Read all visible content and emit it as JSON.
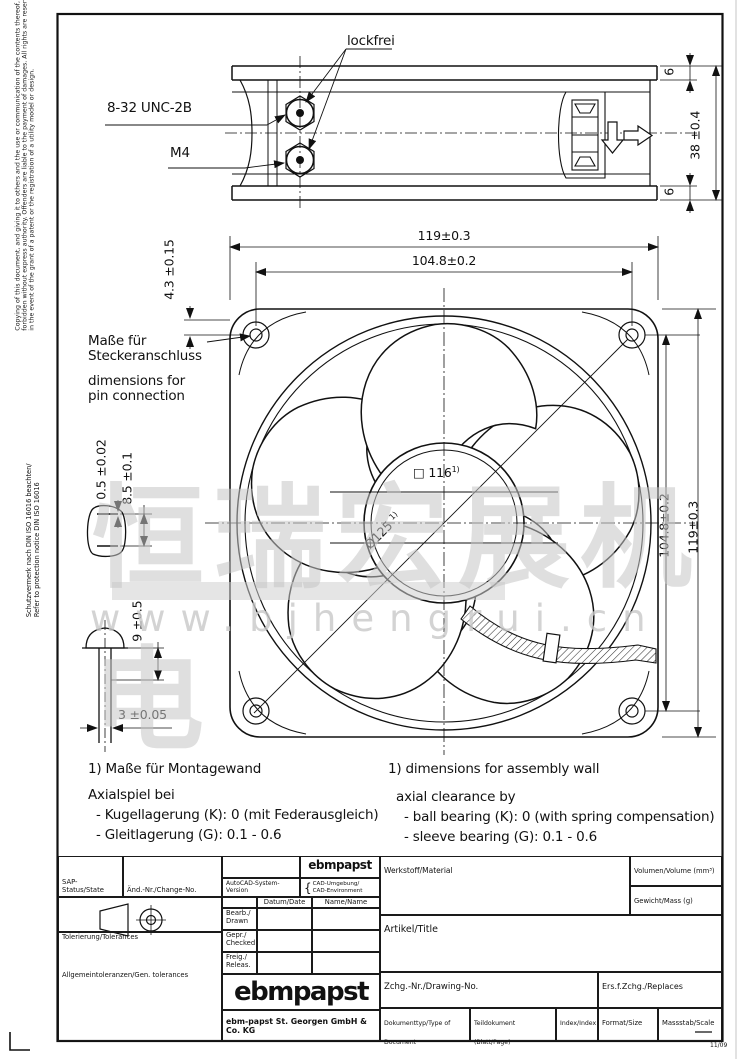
{
  "watermark": {
    "text": "恒瑞宏展机电",
    "url": "www.bjhengrui.cn"
  },
  "margin": {
    "copyright_line1": "Copying of this document, and giving it to others and the use or communication of the contents thereof, are",
    "copyright_line2": "forbidden without express authority. Offenders are liable to the payment of damages. All rights are reserved",
    "copyright_line3": "in the event of the grant of a patent or the registration of a utility model or design.",
    "protection_line1": "Schutzvermerk nach DIN ISO 16016 beachten/",
    "protection_line2": "Refer to protection notice DIN ISO 16016"
  },
  "top_view": {
    "lockfrei": "lockfrei",
    "thread_top": "8-32 UNC-2B",
    "thread_bottom": "M4",
    "dim_flange_top": "6",
    "dim_flange_bottom": "6",
    "dim_depth": "38 ±0.4"
  },
  "front_view": {
    "dim_width": "119±0.3",
    "dim_hole_pitch_top": "104.8±0.2",
    "dim_corner": "4.3 ±0.15",
    "dim_hole_pitch_right": "104.8±0.2",
    "dim_height": "119±0.3",
    "square_symbol": "□",
    "square_value": "116",
    "ref_sup": "1)",
    "diameter_label": "Ø125",
    "pin_note_de1": "Maße für",
    "pin_note_de2": "Steckeranschluss",
    "pin_note_en1": "dimensions for",
    "pin_note_en2": "pin connection",
    "pin_dim_offset": "0.5 ±0.02",
    "pin_dim_depth": "8.5 ±0.1",
    "screw_dim_len": "9 ±0.5",
    "screw_dim_dia": "3 ±0.05"
  },
  "footnotes": {
    "de": [
      "1) Maße für Montagewand",
      "Axialspiel bei",
      "- Kugellagerung (K): 0 (mit Federausgleich)",
      "- Gleitlagerung (G): 0.1 - 0.6"
    ],
    "en": [
      "1) dimensions for assembly wall",
      "axial clearance by",
      "- ball bearing (K): 0 (with spring compensation)",
      "- sleeve bearing (G): 0.1 - 0.6"
    ]
  },
  "title_block": {
    "sap_status": "SAP-Status/State",
    "change_no": "Änd.-Nr./Change-No.",
    "cad_system": "AutoCAD-System-Version",
    "brand_small": "ebmpapst",
    "brace": "{",
    "cad_env_de": "CAD-Umgebung/",
    "cad_env_en": "CAD-Environment",
    "date_header": "Datum/Date",
    "name_header": "Name/Name",
    "drawn_de": "Bearb./",
    "drawn_en": "Drawn",
    "checked_de": "Gepr./",
    "checked_en": "Checked",
    "released_de": "Freig./",
    "released_en": "Releas.",
    "tolerances": "Tolerierung/Tolerances",
    "gen_tolerances": "Allgemeintoleranzen/Gen. tolerances",
    "material": "Werkstoff/Material",
    "volume": "Volumen/Volume (mm³)",
    "mass": "Gewicht/Mass (g)",
    "article": "Artikel/Title",
    "drawing_no": "Zchg.-Nr./Drawing-No.",
    "replaces": "Ers.f.Zchg./Replaces",
    "doc_type": "Dokumenttyp/Type of Document",
    "part_doc": "Teildokument (Blatt/Page)",
    "index": "Index/Index",
    "format": "Format/Size",
    "scale": "Massstab/Scale",
    "logo": "ebmpapst",
    "company": "ebm-papst St. Georgen GmbH & Co. KG",
    "form_rev": "11/09"
  }
}
